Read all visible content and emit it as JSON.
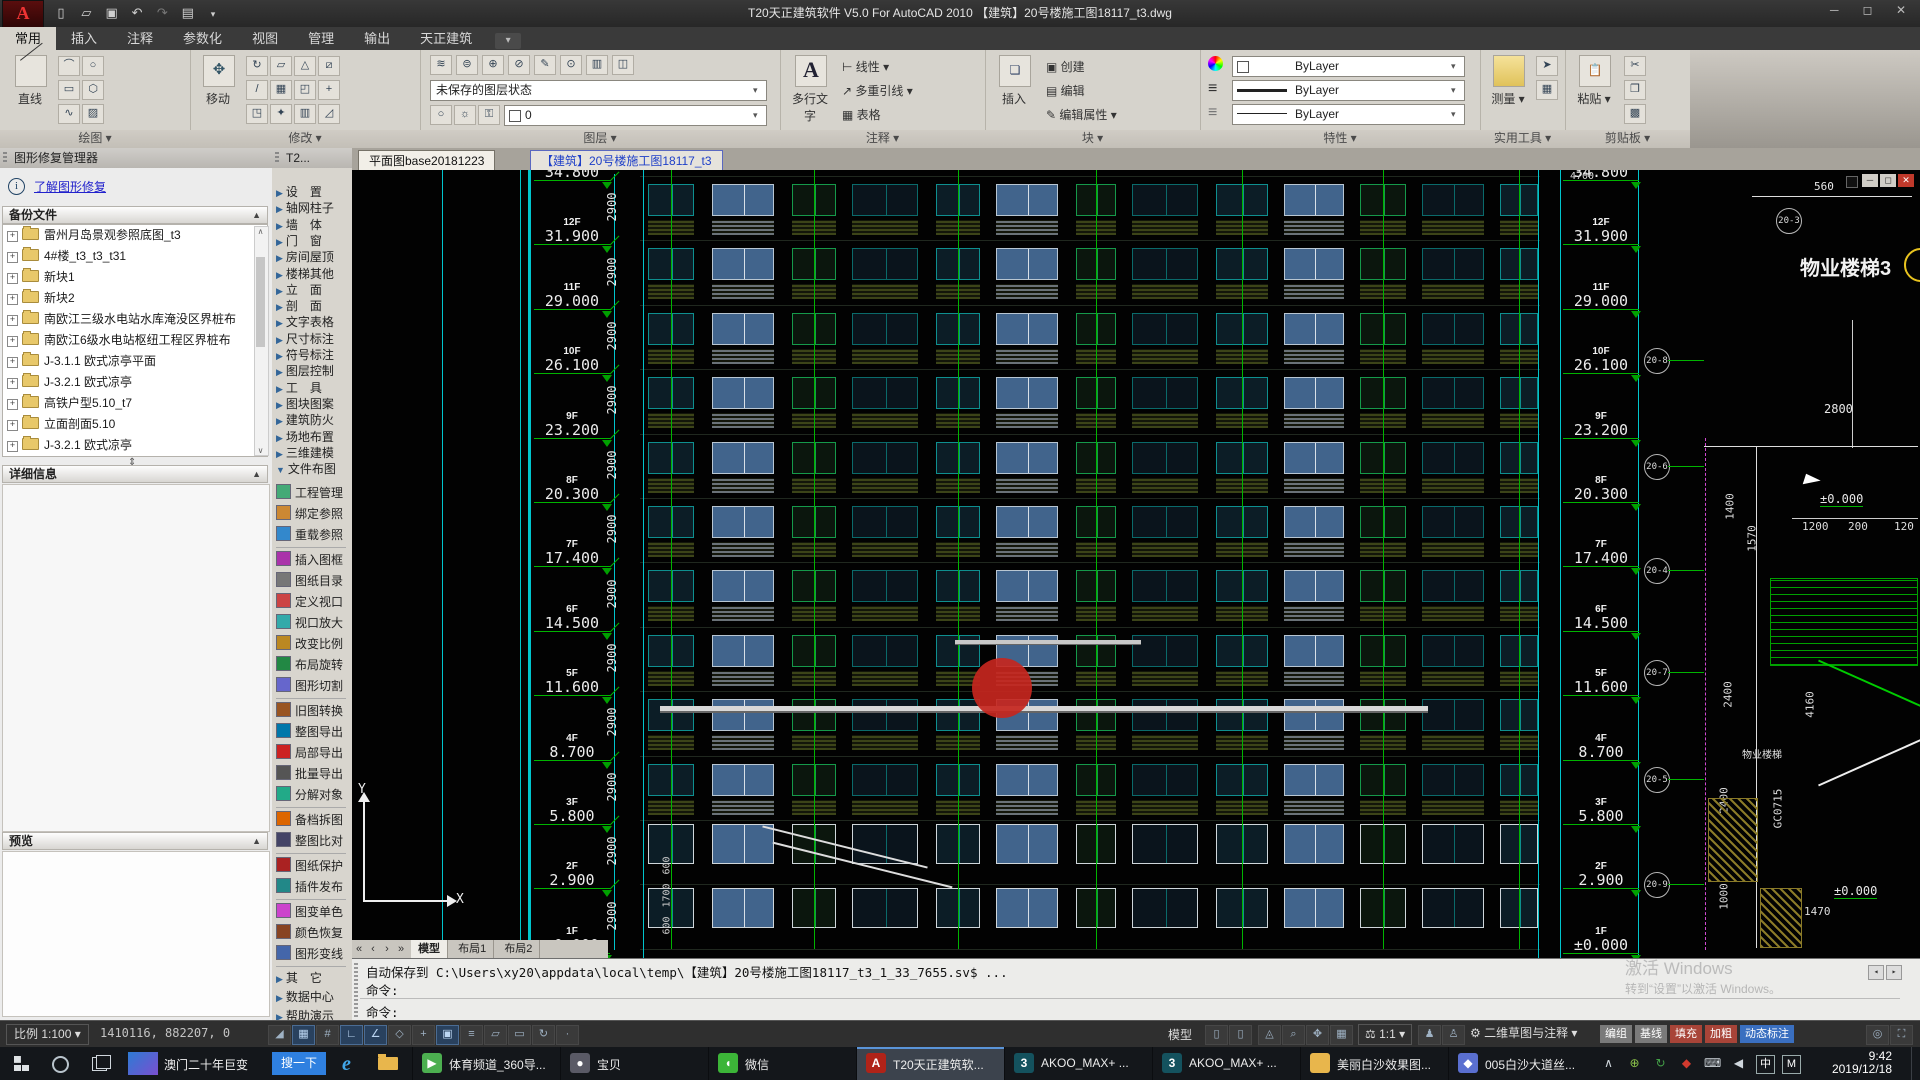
{
  "title_bar": {
    "title": "T20天正建筑软件 V5.0 For AutoCAD 2010      【建筑】20号楼施工图18117_t3.dwg",
    "window_buttons": [
      "─",
      "◻",
      "✕"
    ]
  },
  "ribbon": {
    "tabs": [
      "常用",
      "插入",
      "注释",
      "参数化",
      "视图",
      "管理",
      "输出",
      "天正建筑"
    ],
    "active_tab": "常用",
    "group_labels": [
      "绘图",
      "修改",
      "图层",
      "注释",
      "块",
      "特性",
      "实用工具",
      "剪贴板"
    ],
    "controls": {
      "line": "直线",
      "move": "移动",
      "layer_state": "未保存的图层状态",
      "layer_current": "0",
      "mtext": "多行文字",
      "linear": "线性",
      "mleader": "多重引线",
      "table": "表格",
      "insert": "插入",
      "create": "创建",
      "edit": "编辑",
      "edit_attr": "编辑属性",
      "bylayer1": "ByLayer",
      "bylayer2": "ByLayer",
      "bylayer3": "ByLayer",
      "measure": "测量",
      "paste": "粘贴",
      "mtext_big": "A"
    }
  },
  "repair_panel": {
    "title": "图形修复管理器",
    "learn_link": "了解图形修复",
    "sections": {
      "backup": "备份文件",
      "details": "详细信息",
      "preview": "预览"
    },
    "backup_files": [
      "雷州月岛景观参照底图_t3",
      "4#楼_t3_t3_t31",
      "新块1",
      "新块2",
      "南欧江三级水电站水库淹没区界桩布",
      "南欧江6级水电站枢纽工程区界桩布",
      "J-3.1.1 欧式凉亭平面",
      "J-3.2.1 欧式凉亭",
      "高铁户型5.10_t7",
      "立面剖面5.10",
      "J-3.2.1 欧式凉亭"
    ]
  },
  "tz_palette": {
    "header": "T2...",
    "categories": [
      "设　置",
      "轴网柱子",
      "墙　体",
      "门　窗",
      "房间屋顶",
      "楼梯其他",
      "立　面",
      "剖　面",
      "文字表格",
      "尺寸标注",
      "符号标注",
      "图层控制",
      "工　具",
      "图块图案",
      "建筑防火",
      "场地布置",
      "三维建模",
      "文件布图"
    ],
    "expanded_category": "文件布图",
    "tool_groups": [
      [
        "工程管理",
        "绑定参照",
        "重载参照"
      ],
      [
        "插入图框",
        "图纸目录",
        "定义视口",
        "视口放大",
        "改变比例",
        "布局旋转",
        "图形切割"
      ],
      [
        "旧图转换",
        "整图导出",
        "局部导出",
        "批量导出",
        "分解对象"
      ],
      [
        "备档拆图",
        "整图比对"
      ],
      [
        "图纸保护",
        "插件发布"
      ],
      [
        "图变单色",
        "颜色恢复",
        "图形变线"
      ]
    ],
    "bottom_categories": [
      "其　它",
      "数据中心",
      "帮助演示"
    ]
  },
  "doc_tabs": [
    {
      "label": "平面图base20181223",
      "active": false
    },
    {
      "label": "【建筑】20号楼施工图18117_t3",
      "active": true
    }
  ],
  "drawing": {
    "floors": [
      {
        "f": "13F",
        "e": "34.800"
      },
      {
        "f": "12F",
        "e": "31.900"
      },
      {
        "f": "11F",
        "e": "29.000"
      },
      {
        "f": "10F",
        "e": "26.100"
      },
      {
        "f": "9F",
        "e": "23.200"
      },
      {
        "f": "8F",
        "e": "20.300"
      },
      {
        "f": "7F",
        "e": "17.400"
      },
      {
        "f": "6F",
        "e": "14.500"
      },
      {
        "f": "5F",
        "e": "11.600"
      },
      {
        "f": "4F",
        "e": "8.700"
      },
      {
        "f": "3F",
        "e": "5.800"
      },
      {
        "f": "2F",
        "e": "2.900"
      },
      {
        "f": "1F",
        "e": "±0.000"
      }
    ],
    "floor_dim": "2900",
    "bottom_dims": [
      "600",
      "1700",
      "600"
    ],
    "right": {
      "title": "物业楼梯3",
      "n4700": "4700",
      "n560": "560",
      "n2800": "2800",
      "level_top": "±0.000",
      "level_bottom": "±0.000",
      "row_dims": [
        "1200",
        "200",
        "120"
      ],
      "rot_dims": [
        "1400",
        "1570",
        "2400",
        "4160",
        "2400",
        "1000"
      ],
      "n1470": "1470",
      "code": "GC0715",
      "stair_label": "物业楼梯",
      "bubble_top": "20-3",
      "bubbles": [
        "20-8",
        "20-6",
        "20-4",
        "20-7",
        "20-5",
        "20-9"
      ],
      "mini_buttons": [
        "─",
        "◻",
        "✕"
      ]
    }
  },
  "model_tabs": {
    "model": "模型",
    "layout1": "布局1",
    "layout2": "布局2"
  },
  "command": {
    "line1": "自动保存到 C:\\Users\\xy20\\appdata\\local\\temp\\【建筑】20号楼施工图18117_t3_1_33_7655.sv$ ...",
    "line2": "命令:",
    "prompt": "命令:"
  },
  "status_bar": {
    "scale": "比例 1:100",
    "coords": "1410116, 882207, 0",
    "left_icons": [
      {
        "name": "infer-icon",
        "g": "◢",
        "on": false
      },
      {
        "name": "snap-icon",
        "g": "▦",
        "on": true
      },
      {
        "name": "grid-icon",
        "g": "#",
        "on": false
      },
      {
        "name": "ortho-icon",
        "g": "∟",
        "on": true
      },
      {
        "name": "polar-icon",
        "g": "∠",
        "on": true
      },
      {
        "name": "isodraft-icon",
        "g": "◇",
        "on": false
      },
      {
        "name": "otrack-icon",
        "g": "+",
        "on": false
      },
      {
        "name": "osnap-icon",
        "g": "▣",
        "on": true
      },
      {
        "name": "lineweight-icon",
        "g": "≡",
        "on": false
      },
      {
        "name": "transparency-icon",
        "g": "▱",
        "on": false
      },
      {
        "name": "quickprop-icon",
        "g": "▭",
        "on": false
      },
      {
        "name": "cycling-icon",
        "g": "↻",
        "on": false
      },
      {
        "name": "dyn-icon",
        "g": "·",
        "on": false
      }
    ],
    "model_label": "模型",
    "anno_scale": "1:1",
    "workspace": "二维草图与注释",
    "chips": [
      {
        "label": "编组",
        "color": "#7a7a7a"
      },
      {
        "label": "基线",
        "color": "#7a7a7a"
      },
      {
        "label": "填充",
        "color": "#a84438"
      },
      {
        "label": "加粗",
        "color": "#a84438"
      },
      {
        "label": "动态标注",
        "color": "#3a6fc0"
      }
    ]
  },
  "watermark": {
    "line1": "激活 Windows",
    "line2": "转到“设置”以激活 Windows。"
  },
  "taskbar": {
    "news_label": "澳门二十年巨变",
    "search_button": "搜一下",
    "apps": [
      {
        "label": "体育频道_360导...",
        "color": "#4caf50",
        "g": "▶",
        "active": false
      },
      {
        "label": "宝贝",
        "color": "#5a5a66",
        "g": "●",
        "active": false
      },
      {
        "label": "微信",
        "color": "#3cb538",
        "g": "◖",
        "active": false
      },
      {
        "label": "T20天正建筑软...",
        "color": "#b02318",
        "g": "A",
        "active": true
      },
      {
        "label": "AKOO_MAX+  ...",
        "color": "#14525e",
        "g": "3",
        "active": false
      },
      {
        "label": "AKOO_MAX+  ...",
        "color": "#14525e",
        "g": "3",
        "active": false
      },
      {
        "label": "美丽白沙效果图...",
        "color": "#e8b64c",
        "g": "",
        "active": false
      },
      {
        "label": "005白沙大道丝...",
        "color": "#5a6fd0",
        "g": "◆",
        "active": false
      }
    ],
    "tray_glyphs": [
      "∧",
      "⊕",
      "↻",
      "◆",
      "⌨",
      "◀",
      "中",
      "M"
    ],
    "time": "9:42",
    "date": "2019/12/18"
  }
}
